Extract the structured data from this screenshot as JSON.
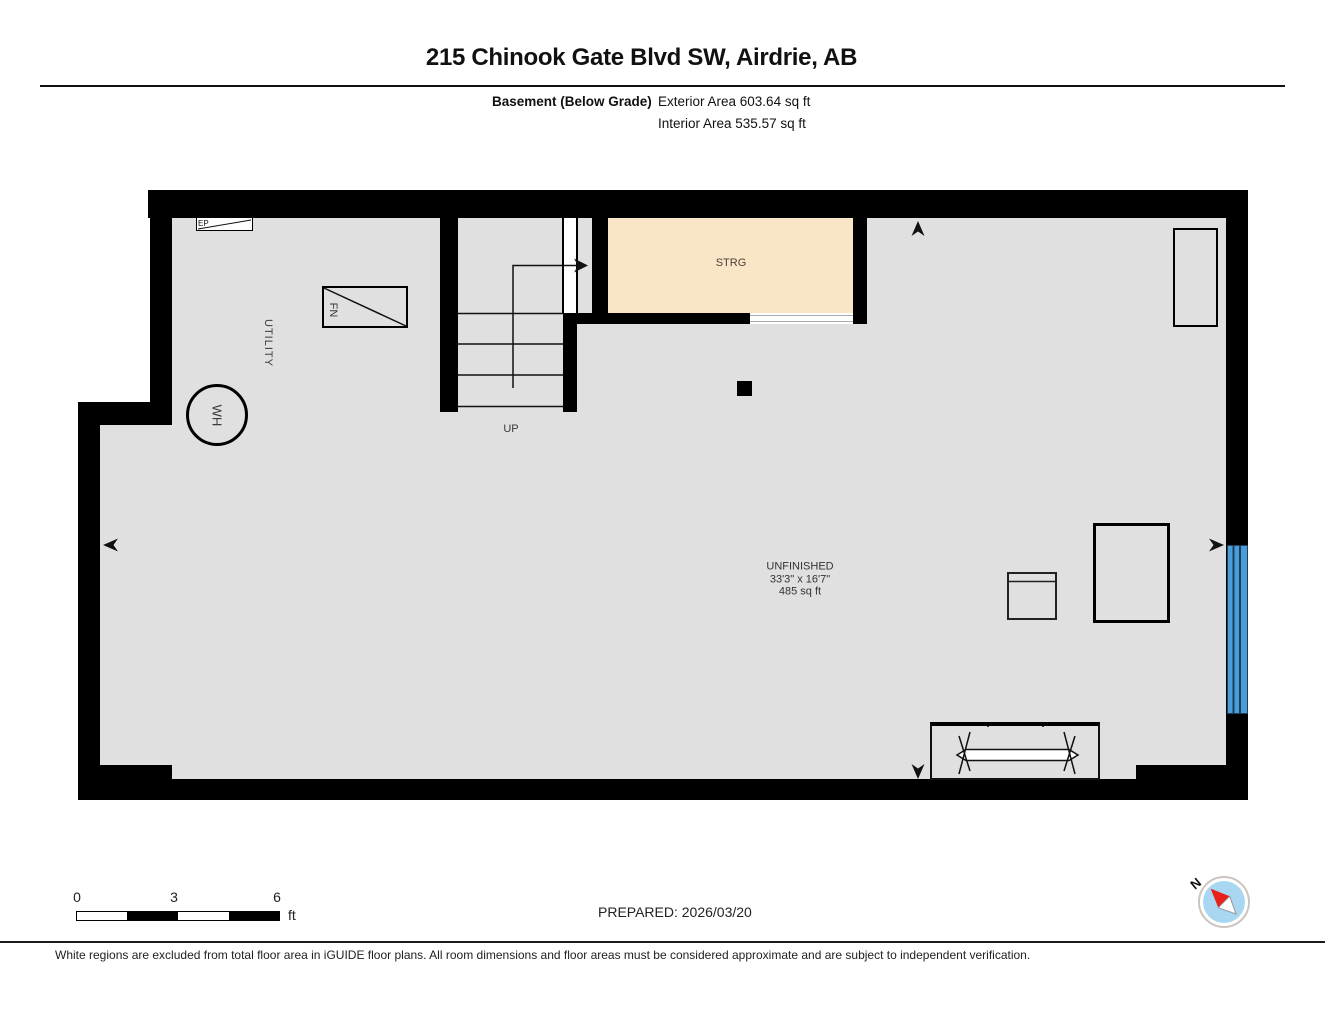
{
  "header": {
    "title": "215 Chinook Gate Blvd SW, Airdrie, AB",
    "floor_label": "Basement (Below Grade)",
    "exterior_area": "Exterior Area 603.64 sq ft",
    "interior_area": "Interior Area 535.57 sq ft"
  },
  "plan": {
    "rooms": {
      "utility_label": "UTILITY",
      "storage_label": "STRG",
      "unfinished_name": "UNFINISHED",
      "unfinished_dimensions": "33'3\" x 16'7\"",
      "unfinished_area": "485 sq ft"
    },
    "fixtures": {
      "furnace_label": "FN",
      "water_heater_label": "WH",
      "electrical_panel_label": "EP",
      "stairs_label": "UP"
    },
    "colors": {
      "wall": "#000000",
      "floor": "#e0e0e0",
      "storage_fill": "#fae6c6",
      "window": "#4a9ed8",
      "compass_blue": "#a9d6f0",
      "needle_red": "#e8211a"
    }
  },
  "scale_bar": {
    "tick_0": "0",
    "tick_3": "3",
    "tick_6": "6",
    "unit": "ft"
  },
  "footer": {
    "prepared": "PREPARED: 2026/03/20",
    "compass_north": "N",
    "disclaimer": "White regions are excluded from total floor area in iGUIDE floor plans. All room dimensions and floor areas must be considered approximate and are subject to independent verification."
  }
}
